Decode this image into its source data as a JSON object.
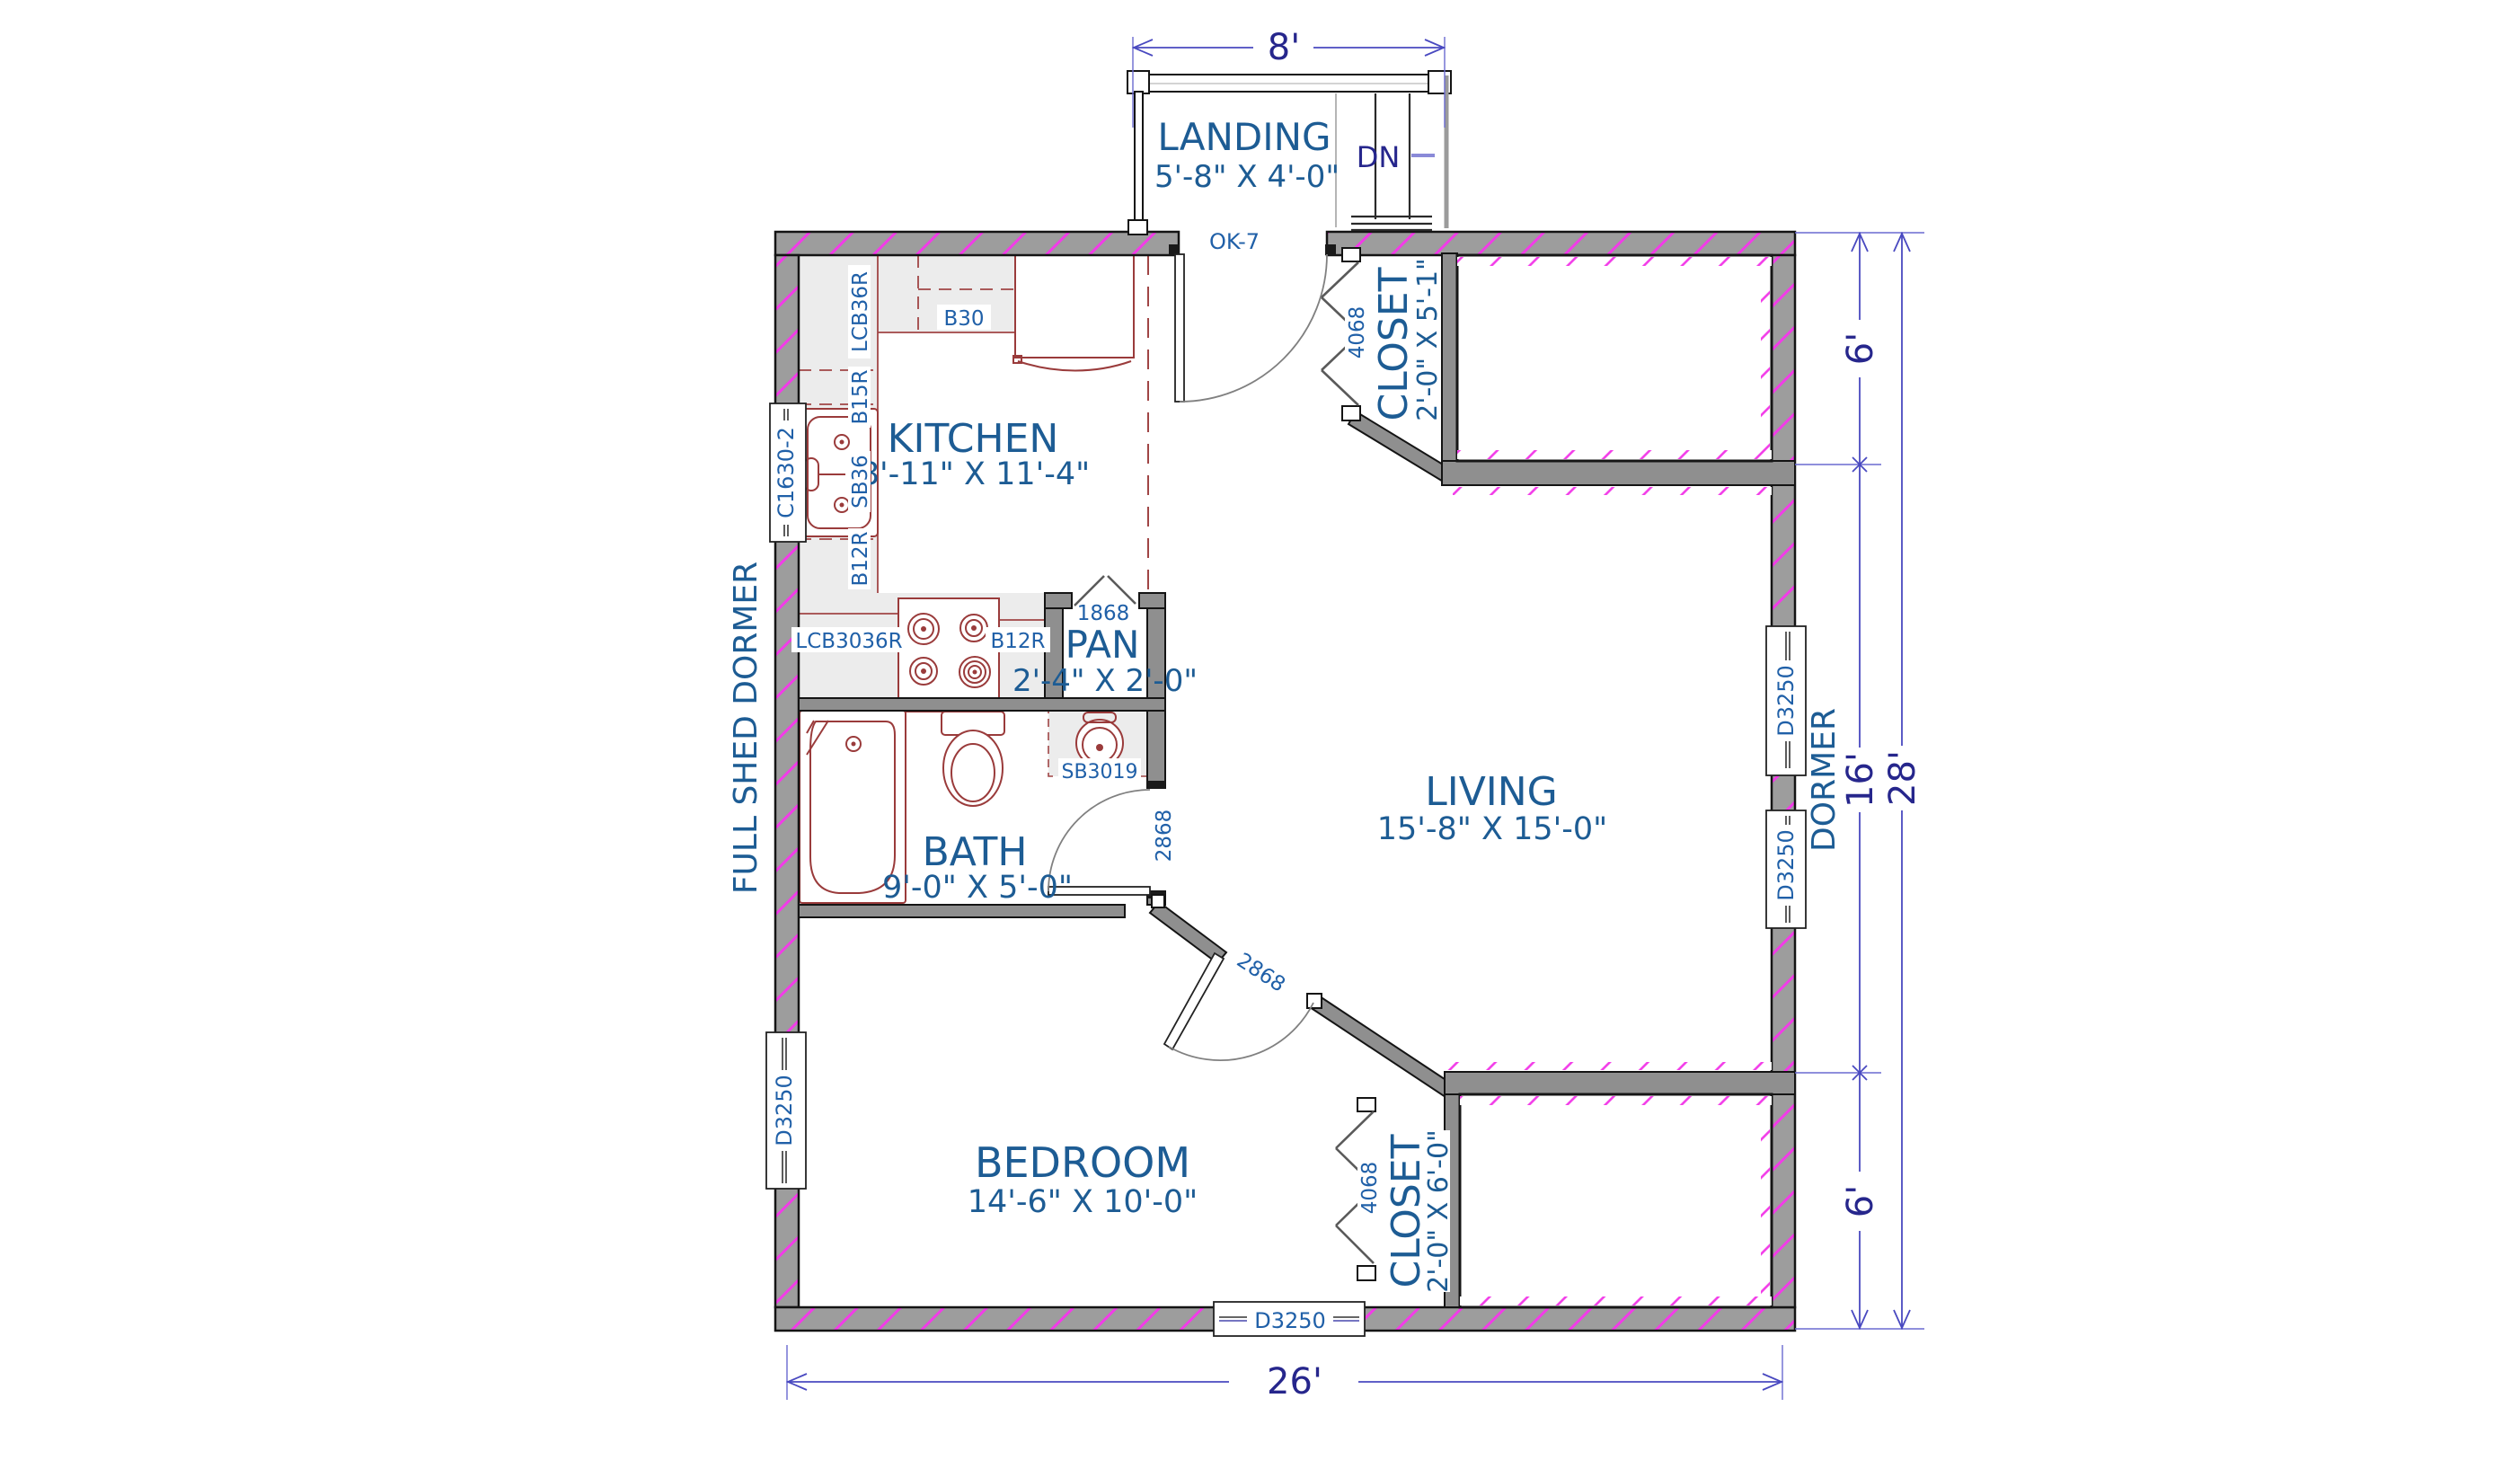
{
  "rooms": {
    "landing": {
      "name": "LANDING",
      "dims": "5'-8\" X 4'-0\""
    },
    "kitchen": {
      "name": "KITCHEN",
      "dims": "8'-11\" X 11'-4\""
    },
    "pantry": {
      "name": "PAN",
      "dims": "2'-4\" X 2'-0\""
    },
    "living": {
      "name": "LIVING",
      "dims": "15'-8\" X 15'-0\""
    },
    "bath": {
      "name": "BATH",
      "dims": "9'-0\" X 5'-0\""
    },
    "bedroom": {
      "name": "BEDROOM",
      "dims": "14'-6\" X 10'-0\""
    },
    "closet_upper": {
      "name": "CLOSET",
      "dims": "2'-0\" X 5'-1\""
    },
    "closet_lower": {
      "name": "CLOSET",
      "dims": "2'-0\" X 6'-0\""
    }
  },
  "annotations": {
    "stair": "DN",
    "entry_door": "OK-7",
    "left_dormer": "FULL SHED DORMER",
    "right_dormer": "DORMER"
  },
  "door_schedule": {
    "pantry": "1868",
    "closet_upper": "4068",
    "closet_lower": "4068",
    "bath": "2868",
    "bedroom": "2868"
  },
  "window_schedule": {
    "kitchen_left": "C1630-2",
    "bedroom_left": "D3250",
    "living_right_upper": "D3250",
    "living_right_lower": "D3250",
    "bedroom_bottom": "D3250"
  },
  "cabinet_schedule": {
    "wall_corner": "LCB36R",
    "wall_30": "B30",
    "base_15": "B15R",
    "sink_base": "SB36",
    "base_12_upper": "B12R",
    "base_corner": "LCB3036R",
    "base_12_lower": "B12R",
    "bath_vanity": "SB3019"
  },
  "dimensions": {
    "landing_width": "8'",
    "overall_width": "26'",
    "right_upper": "6'",
    "right_middle": "16'",
    "right_lower": "6'",
    "overall_depth": "28'"
  },
  "colors": {
    "label_blue": "#1d5c94",
    "dim_blue": "#26268c",
    "fixture_red": "#9a3b3b",
    "wall_gray": "#9d9d9d",
    "hatch_magenta": "#f23be8"
  }
}
